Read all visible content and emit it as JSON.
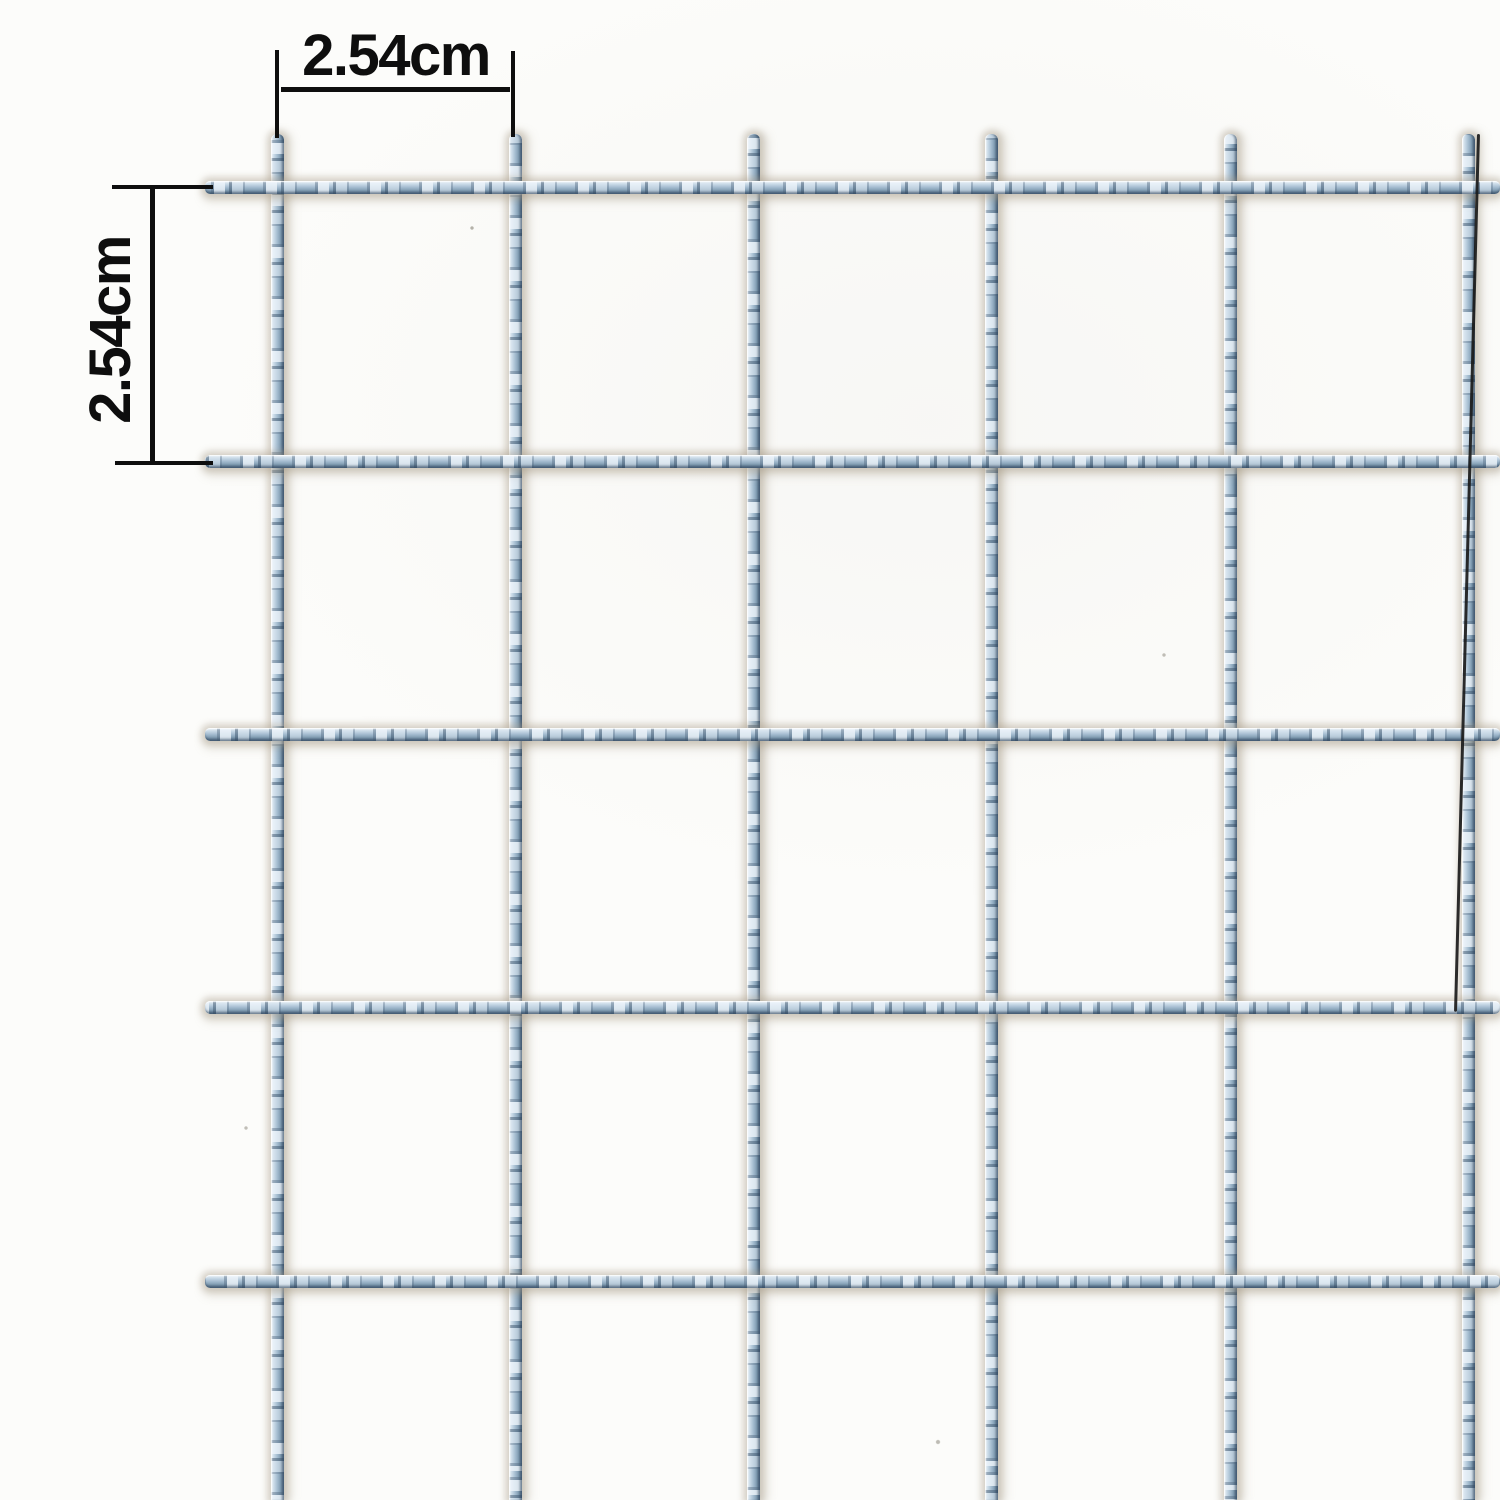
{
  "subject": "galvanized welded wire mesh close-up with opening dimensions",
  "dimensions": {
    "top_label": "2.54cm",
    "left_label": "2.54cm"
  },
  "mesh": {
    "vertical_wires_x": [
      277,
      515,
      753,
      991,
      1230,
      1468
    ],
    "horizontal_wires_y": [
      187,
      461,
      734,
      1007,
      1281
    ],
    "left_edge_x": 205,
    "top_edge_y": 134,
    "wire_thickness_px": 13
  },
  "colors": {
    "background": "#fcfcfa",
    "annotation": "#0e0e0e",
    "wire_highlight": "#eff5fa",
    "wire_light": "#c7d8e6",
    "wire_mid": "#9fb8cc",
    "wire_dark": "#7e99af",
    "wire_edge": "#5d7890",
    "halo": "rgba(167,156,135,0.42)",
    "halo_soft": "rgba(160,150,128,0.22)",
    "edge_line": "#1a1a1a"
  }
}
